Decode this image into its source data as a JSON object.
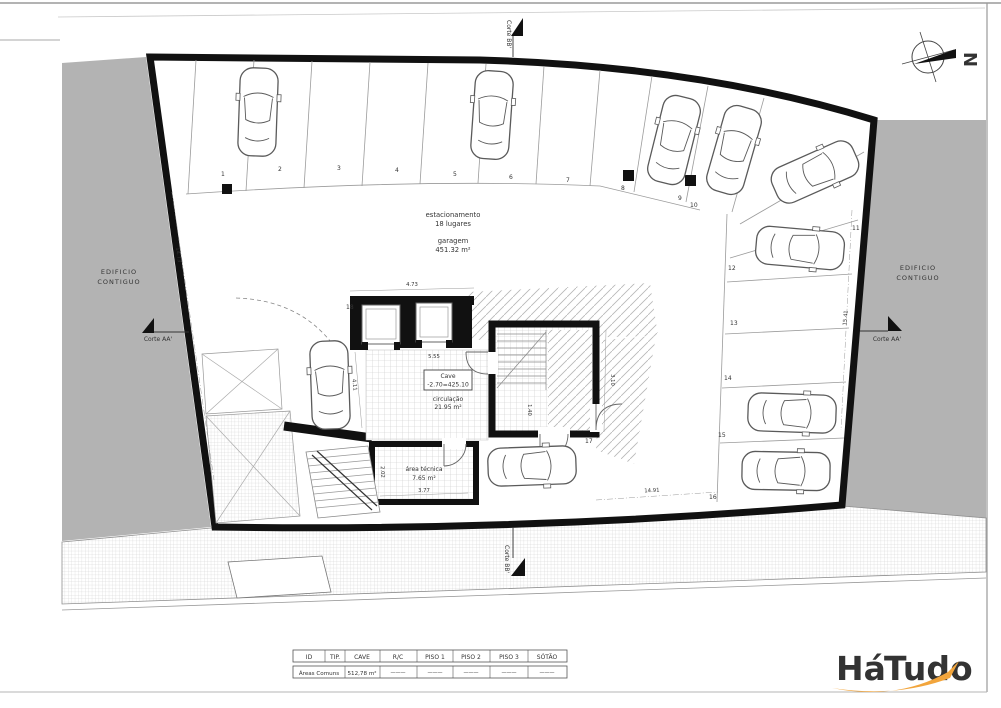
{
  "plan": {
    "labels": {
      "estacionamento": "estacionamento",
      "lugares": "18 lugares",
      "garagem": "garagem",
      "garagem_area": "451.32 m²",
      "cave": "Cave",
      "cave_level": "-2.70=425.10",
      "circulacao": "circulação",
      "circulacao_area": "21.95 m²",
      "area_tecnica": "área técnica",
      "area_tecnica_area": "7.65 m²",
      "edificio_line1": "EDIFICIO",
      "edificio_line2": "CONTIGUO",
      "corte_aa": "Corte AA'",
      "corte_bb": "Corte BB'",
      "north_letter": "N"
    },
    "space_numbers": [
      "1",
      "2",
      "3",
      "4",
      "5",
      "6",
      "7",
      "8",
      "9",
      "10",
      "11",
      "12",
      "13",
      "14",
      "15",
      "16",
      "17",
      "18"
    ],
    "dimensions": {
      "left_wall": "14.73",
      "elevators_width": "4.73",
      "below_elevators": "5.55",
      "stair_core": "3.10",
      "area_tecnica_width": "3.77",
      "bottom_span": "14.91",
      "right_wall": "15.41",
      "ramp": "4.11",
      "tecnica_side": "2.02",
      "corridor": "1.40"
    }
  },
  "table": {
    "headers": [
      "ID",
      "TIP.",
      "CAVE",
      "R/C",
      "PISO 1",
      "PISO 2",
      "PISO 3",
      "SÓTÃO"
    ],
    "row_label": "Áreas Comuns",
    "cave_value": "512,78 m²",
    "empty_dash": "———"
  },
  "logo": {
    "word1": "Há",
    "word2": "Tudo",
    "color1": "#F2A53C",
    "color2": "#56A5DB"
  }
}
